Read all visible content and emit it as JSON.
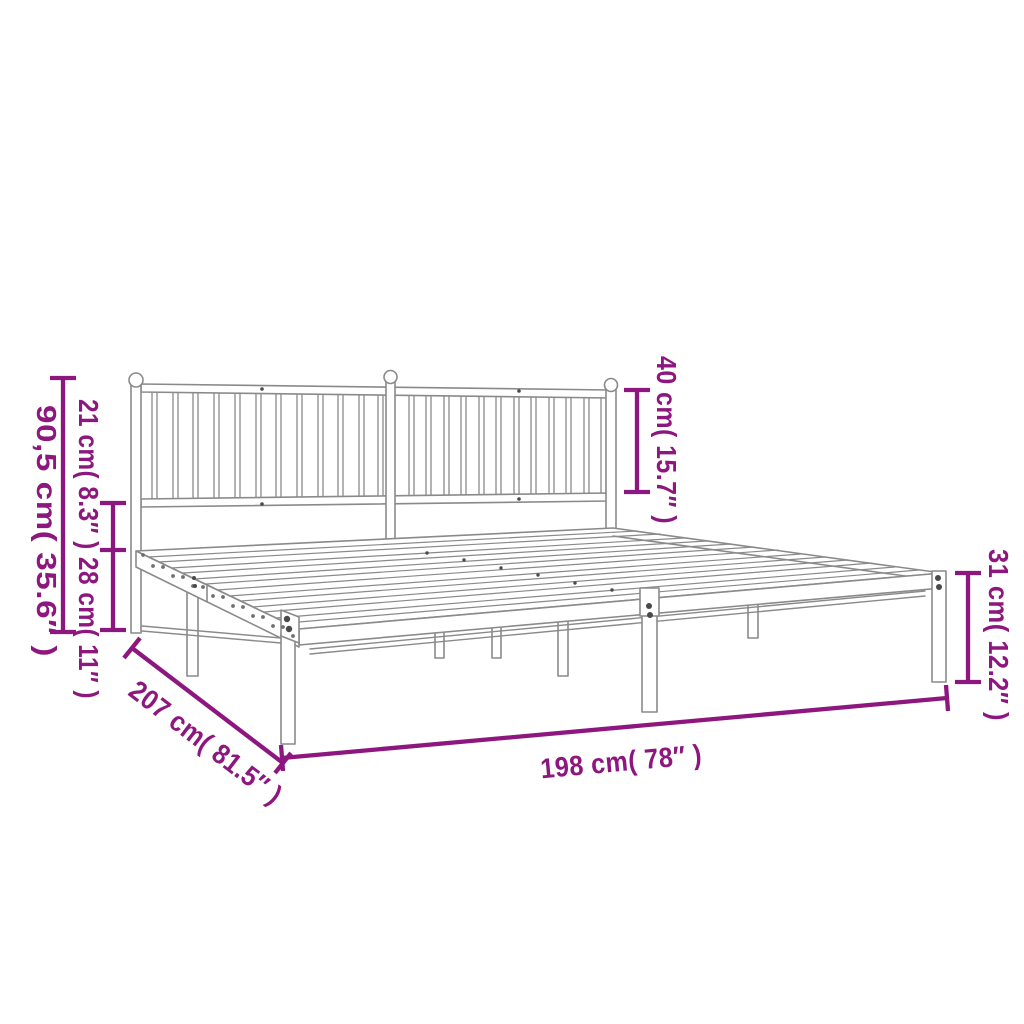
{
  "diagram": {
    "colors": {
      "dimension": "#8D177E",
      "frame_line": "#8A8A8A",
      "hole": "#6F6F6F",
      "bolt": "#4A4A4A"
    },
    "annotations": {
      "height_total": "90,5 cm( 35.6″ )",
      "headboard_sections": "21 cm( 8.3″ ) 28 cm( 11″ )",
      "headboard_height": "40 cm( 15.7″ )",
      "frame_height": "31 cm( 12.2″ )",
      "width": "198 cm( 78″ )",
      "length": "207 cm( 81.5″ )"
    }
  }
}
